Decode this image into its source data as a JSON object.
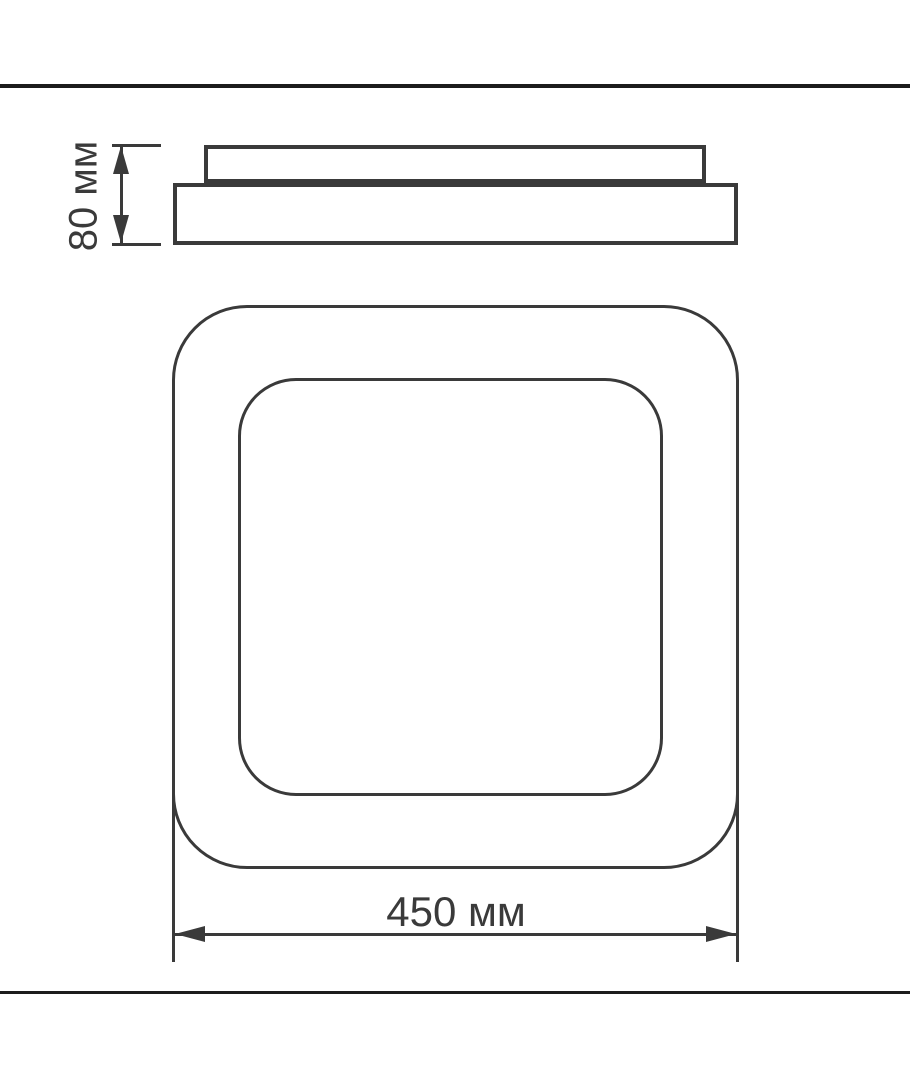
{
  "page": {
    "background_color": "#ffffff",
    "frame_rule_color": "#1c1c1c",
    "line_color": "#3a3a3a"
  },
  "dimensions": {
    "height": {
      "label": "80 мм"
    },
    "width": {
      "label": "450 мм"
    }
  }
}
